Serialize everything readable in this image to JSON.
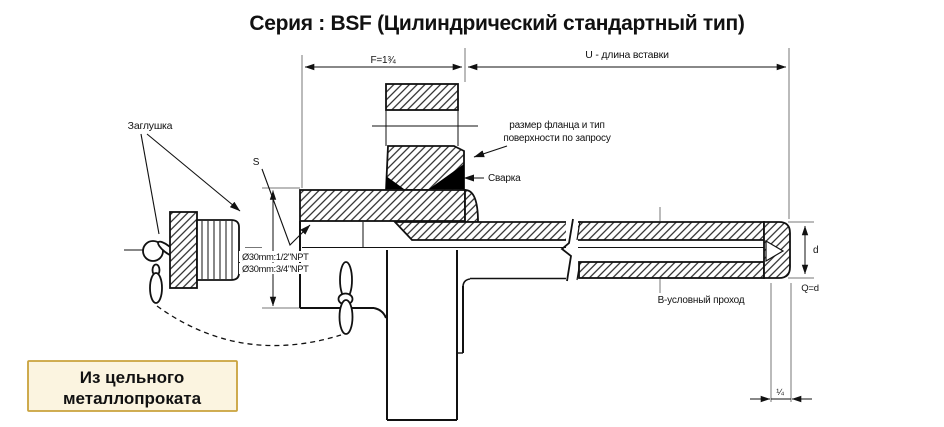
{
  "title": "Серия : BSF (Цилиндрический стандартный тип)",
  "dimensions": {
    "f": "F=1¾",
    "u": "U - длина вставки",
    "s": "S",
    "d": "d",
    "q": "Q=d",
    "quarter": "¼"
  },
  "labels": {
    "plug": "Заглушка",
    "npt_small": "Ø30mm:1/2\"NPT",
    "npt_large": "Ø30mm:3/4\"NPT",
    "flange_note_1": "размер фланца и тип",
    "flange_note_2": "поверхности по запросу",
    "weld": "Сварка",
    "bore": "B-условный проход"
  },
  "callout_box": {
    "line1": "Из цельного",
    "line2": "металлопроката"
  },
  "colors": {
    "line": "#111111",
    "aux_line": "#777777",
    "weld_fill": "#000000",
    "box_bg": "#fbf4e0",
    "box_border": "#c9a23c"
  }
}
